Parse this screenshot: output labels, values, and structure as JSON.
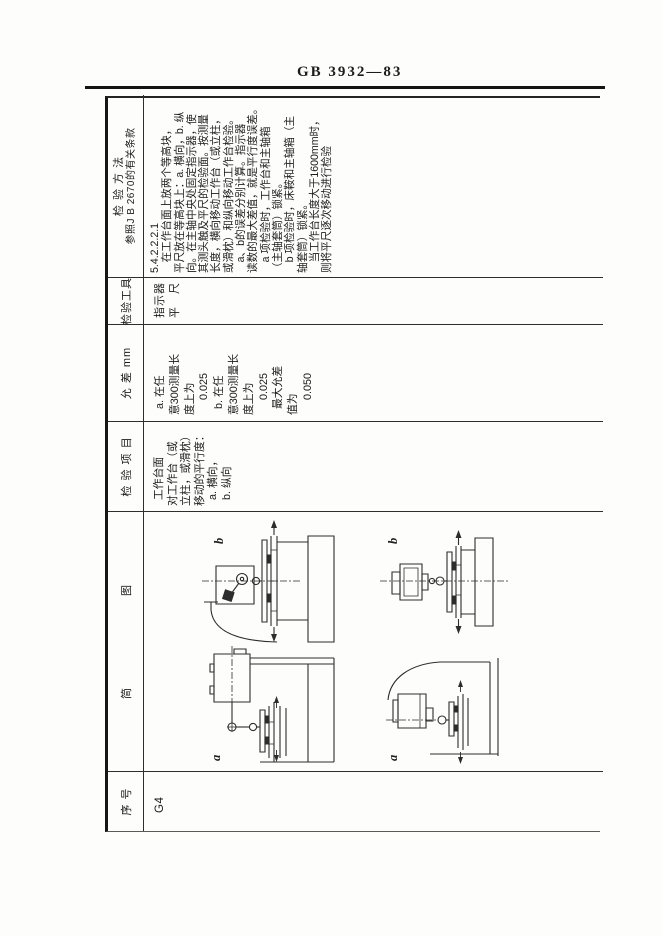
{
  "page": {
    "standard_no": "GB 3932—83"
  },
  "table": {
    "headers": {
      "seq": "序 号",
      "diagram": [
        "简",
        "图"
      ],
      "item": "检 验 项 目",
      "tolerance": "允 差   mm",
      "tools": "检验工具",
      "method_line1": "检 验 方 法",
      "method_line2": "参照J B 2670的有关条款"
    },
    "row": {
      "seq": "G4",
      "item": "  工作台面\n对工作台（或\n立柱，或滑枕）\n移动的平行度：\n  a. 横向，\n  b. 纵向",
      "tolerance": "  a. 在任\n意300测量长\n度上为\n     0.025\n  b. 在任\n意300测量长\n度上为\n     0.025\n  最大允差\n值为\n     0.050",
      "tools": "指示器\n平　尺",
      "method": "5.4.2.2.2.1\n　在工作台面上放两个等高块，\n平尺放在等高块上：a. 横向，b. 纵\n向。在主轴中央处固定指示器，使\n其测头触及平尺的检验面。按测量\n长度，横向移动工作台（或立柱，\n或滑枕）和纵向移动工作台检验。\n　a、b的误差分别计算。指示器\n读数的最大差值，就是平行度误差。\n　a 项检验时，工作台和主轴箱\n（主轴套筒）锁紧。\n　b 项检验时，床鞍和主轴箱（主\n轴套筒）锁紧。\n　当工作台长度大于1600mm时，\n则将平尺逐次移动进行检验",
      "diagram_labels": {
        "b1": "b",
        "a1": "a",
        "b2": "b",
        "a2": "a"
      }
    }
  }
}
